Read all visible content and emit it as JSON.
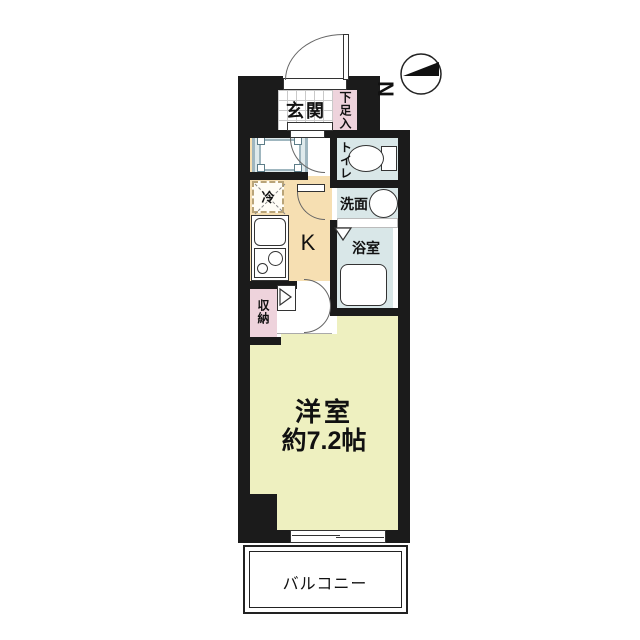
{
  "compass": {
    "north_label": "N"
  },
  "rooms": {
    "entrance": {
      "label": "玄関"
    },
    "shoe_storage": {
      "label": "下足入"
    },
    "toilet": {
      "label": "トイレ"
    },
    "washroom": {
      "label": "洗面"
    },
    "bathroom": {
      "label": "浴室"
    },
    "kitchen": {
      "label": "K"
    },
    "refrigerator": {
      "label": "冷"
    },
    "storage": {
      "label": "収納"
    },
    "main_room": {
      "label": "洋室",
      "size": "約7.2帖"
    },
    "balcony": {
      "label": "バルコニー"
    }
  },
  "colors": {
    "wall": "#1b1b1b",
    "kitchen_floor": "#f6dfb2",
    "main_room_floor": "#eef0c0",
    "closet_pink": "#eed3dc",
    "wet_area_blue": "#d9e7e8",
    "pan_border": "#9fb6bf",
    "background": "#ffffff"
  }
}
